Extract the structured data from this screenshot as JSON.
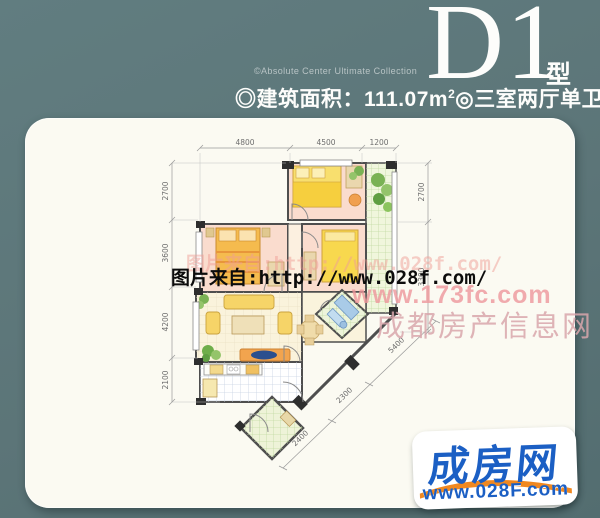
{
  "header": {
    "collection": "©Absolute Center Ultimate Collection",
    "code": "D1",
    "type_suffix": "型",
    "bullet1": "◎",
    "area_label": "建筑面积：",
    "area_value": "111.07m",
    "area_exp": "2",
    "bullet2": "◎",
    "layout_label": "三室两厅单卫"
  },
  "floorplan": {
    "dims_top": [
      "4800",
      "4500",
      "1200"
    ],
    "dims_left": [
      "2700",
      "3600",
      "4200",
      "2100"
    ],
    "dims_right": [
      "2700",
      "3300"
    ],
    "dims_diag": [
      "2400",
      "2300",
      "5400"
    ]
  },
  "watermarks": {
    "ghost": "图片来自:http://www.028f.com/",
    "main": "图片来自:http://www.028f.com/",
    "site": "www.173fc.com",
    "site_name": "成都房产信息网"
  },
  "logo": {
    "brand": "成房网",
    "url": "www.028F.com"
  },
  "colors": {
    "background": "#5c7578",
    "card": "#fbfaf2",
    "room_pink": "#fadcce",
    "tile_green": "#f0f6dc",
    "logo_blue": "#1b5fc4",
    "logo_orange": "#f08820"
  }
}
